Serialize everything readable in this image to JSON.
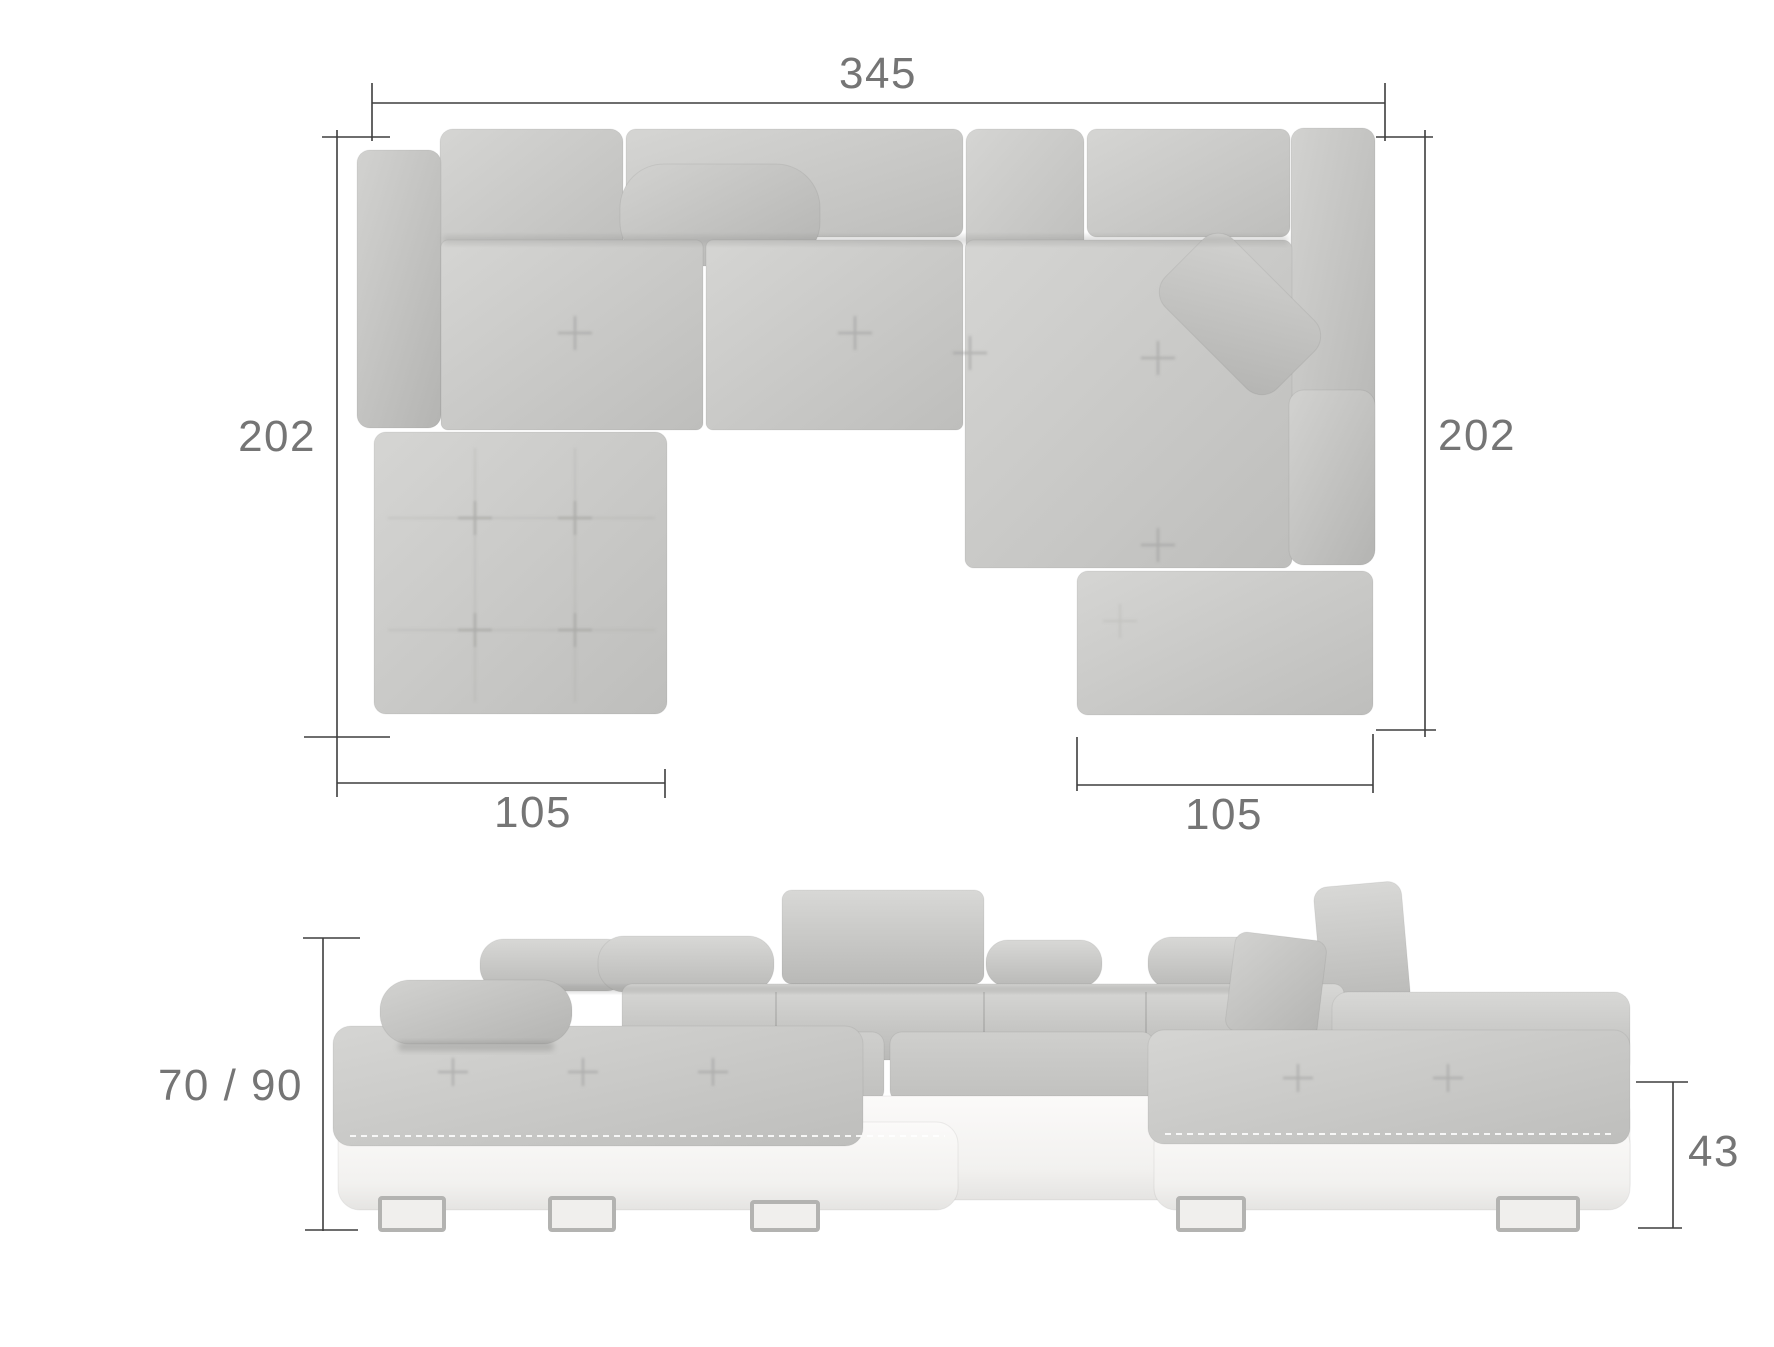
{
  "diagram": {
    "views": {
      "top_view_name": "top-view",
      "front_view_name": "front-view"
    },
    "dimensions": {
      "total_width": "345",
      "left_side_depth": "202",
      "right_side_depth": "202",
      "left_chaise_width": "105",
      "right_chaise_width": "105",
      "overall_height": "70 / 90",
      "seat_height": "43"
    },
    "colors": {
      "background": "#ffffff",
      "fabric": "#c6c6c4",
      "fabric_light": "#d7d7d5",
      "fabric_dark": "#b6b6b4",
      "base_white": "#f7f6f4",
      "chrome": "#b3b3b1",
      "dimension_line": "#3e3e3e",
      "dimension_text": "#757575"
    }
  }
}
